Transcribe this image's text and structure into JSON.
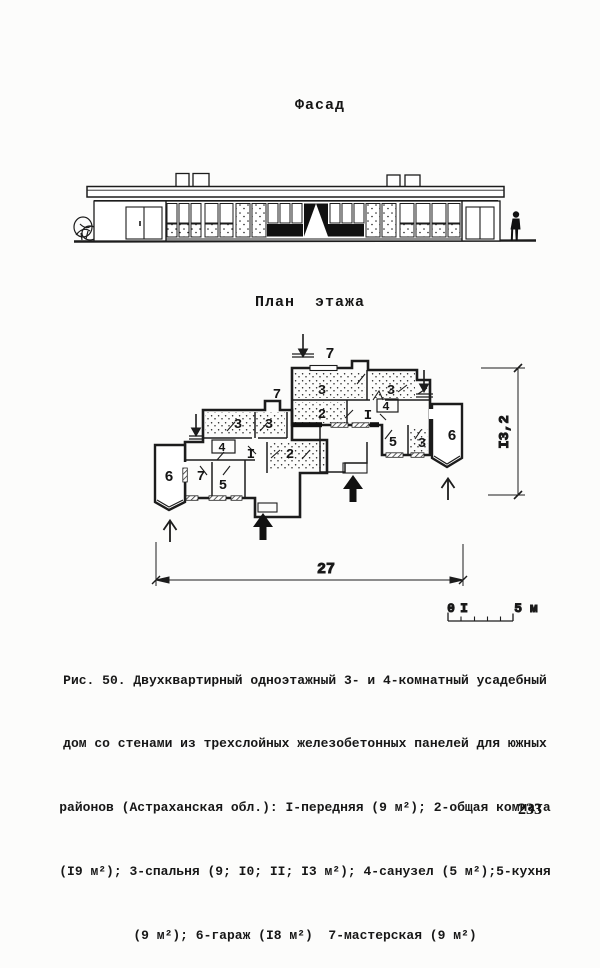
{
  "page": {
    "number": "233",
    "paper_color": "#fcfcfb",
    "ink_color": "#1c1c1c"
  },
  "facade": {
    "title": "Фасад"
  },
  "plan": {
    "title": "План  этажа",
    "room_labels": [
      "7",
      "3",
      "3",
      "2",
      "I",
      "4",
      "5",
      "3",
      "6",
      "7",
      "3",
      "3",
      "4",
      "I",
      "2",
      "7",
      "5",
      "6"
    ],
    "dimensions": {
      "width": "27",
      "height": "I3,2"
    },
    "scale_bar": {
      "zero": "0",
      "one": "I",
      "five": "5 м"
    }
  },
  "caption": {
    "lines": [
      "Рис. 50. Двухквартирный одноэтажный 3- и 4-комнатный усадебный",
      "дом со стенами из трехслойных железобетонных панелей для южных",
      "районов (Астраханская обл.): I-передняя (9 м²); 2-общая комната",
      "(I9 м²); 3-спальня (9; I0; II; I3 м²); 4-санузел (5 м²);5-кухня",
      "(9 м²); 6-гараж (I8 м²)  7-мастерская (9 м²)"
    ]
  }
}
